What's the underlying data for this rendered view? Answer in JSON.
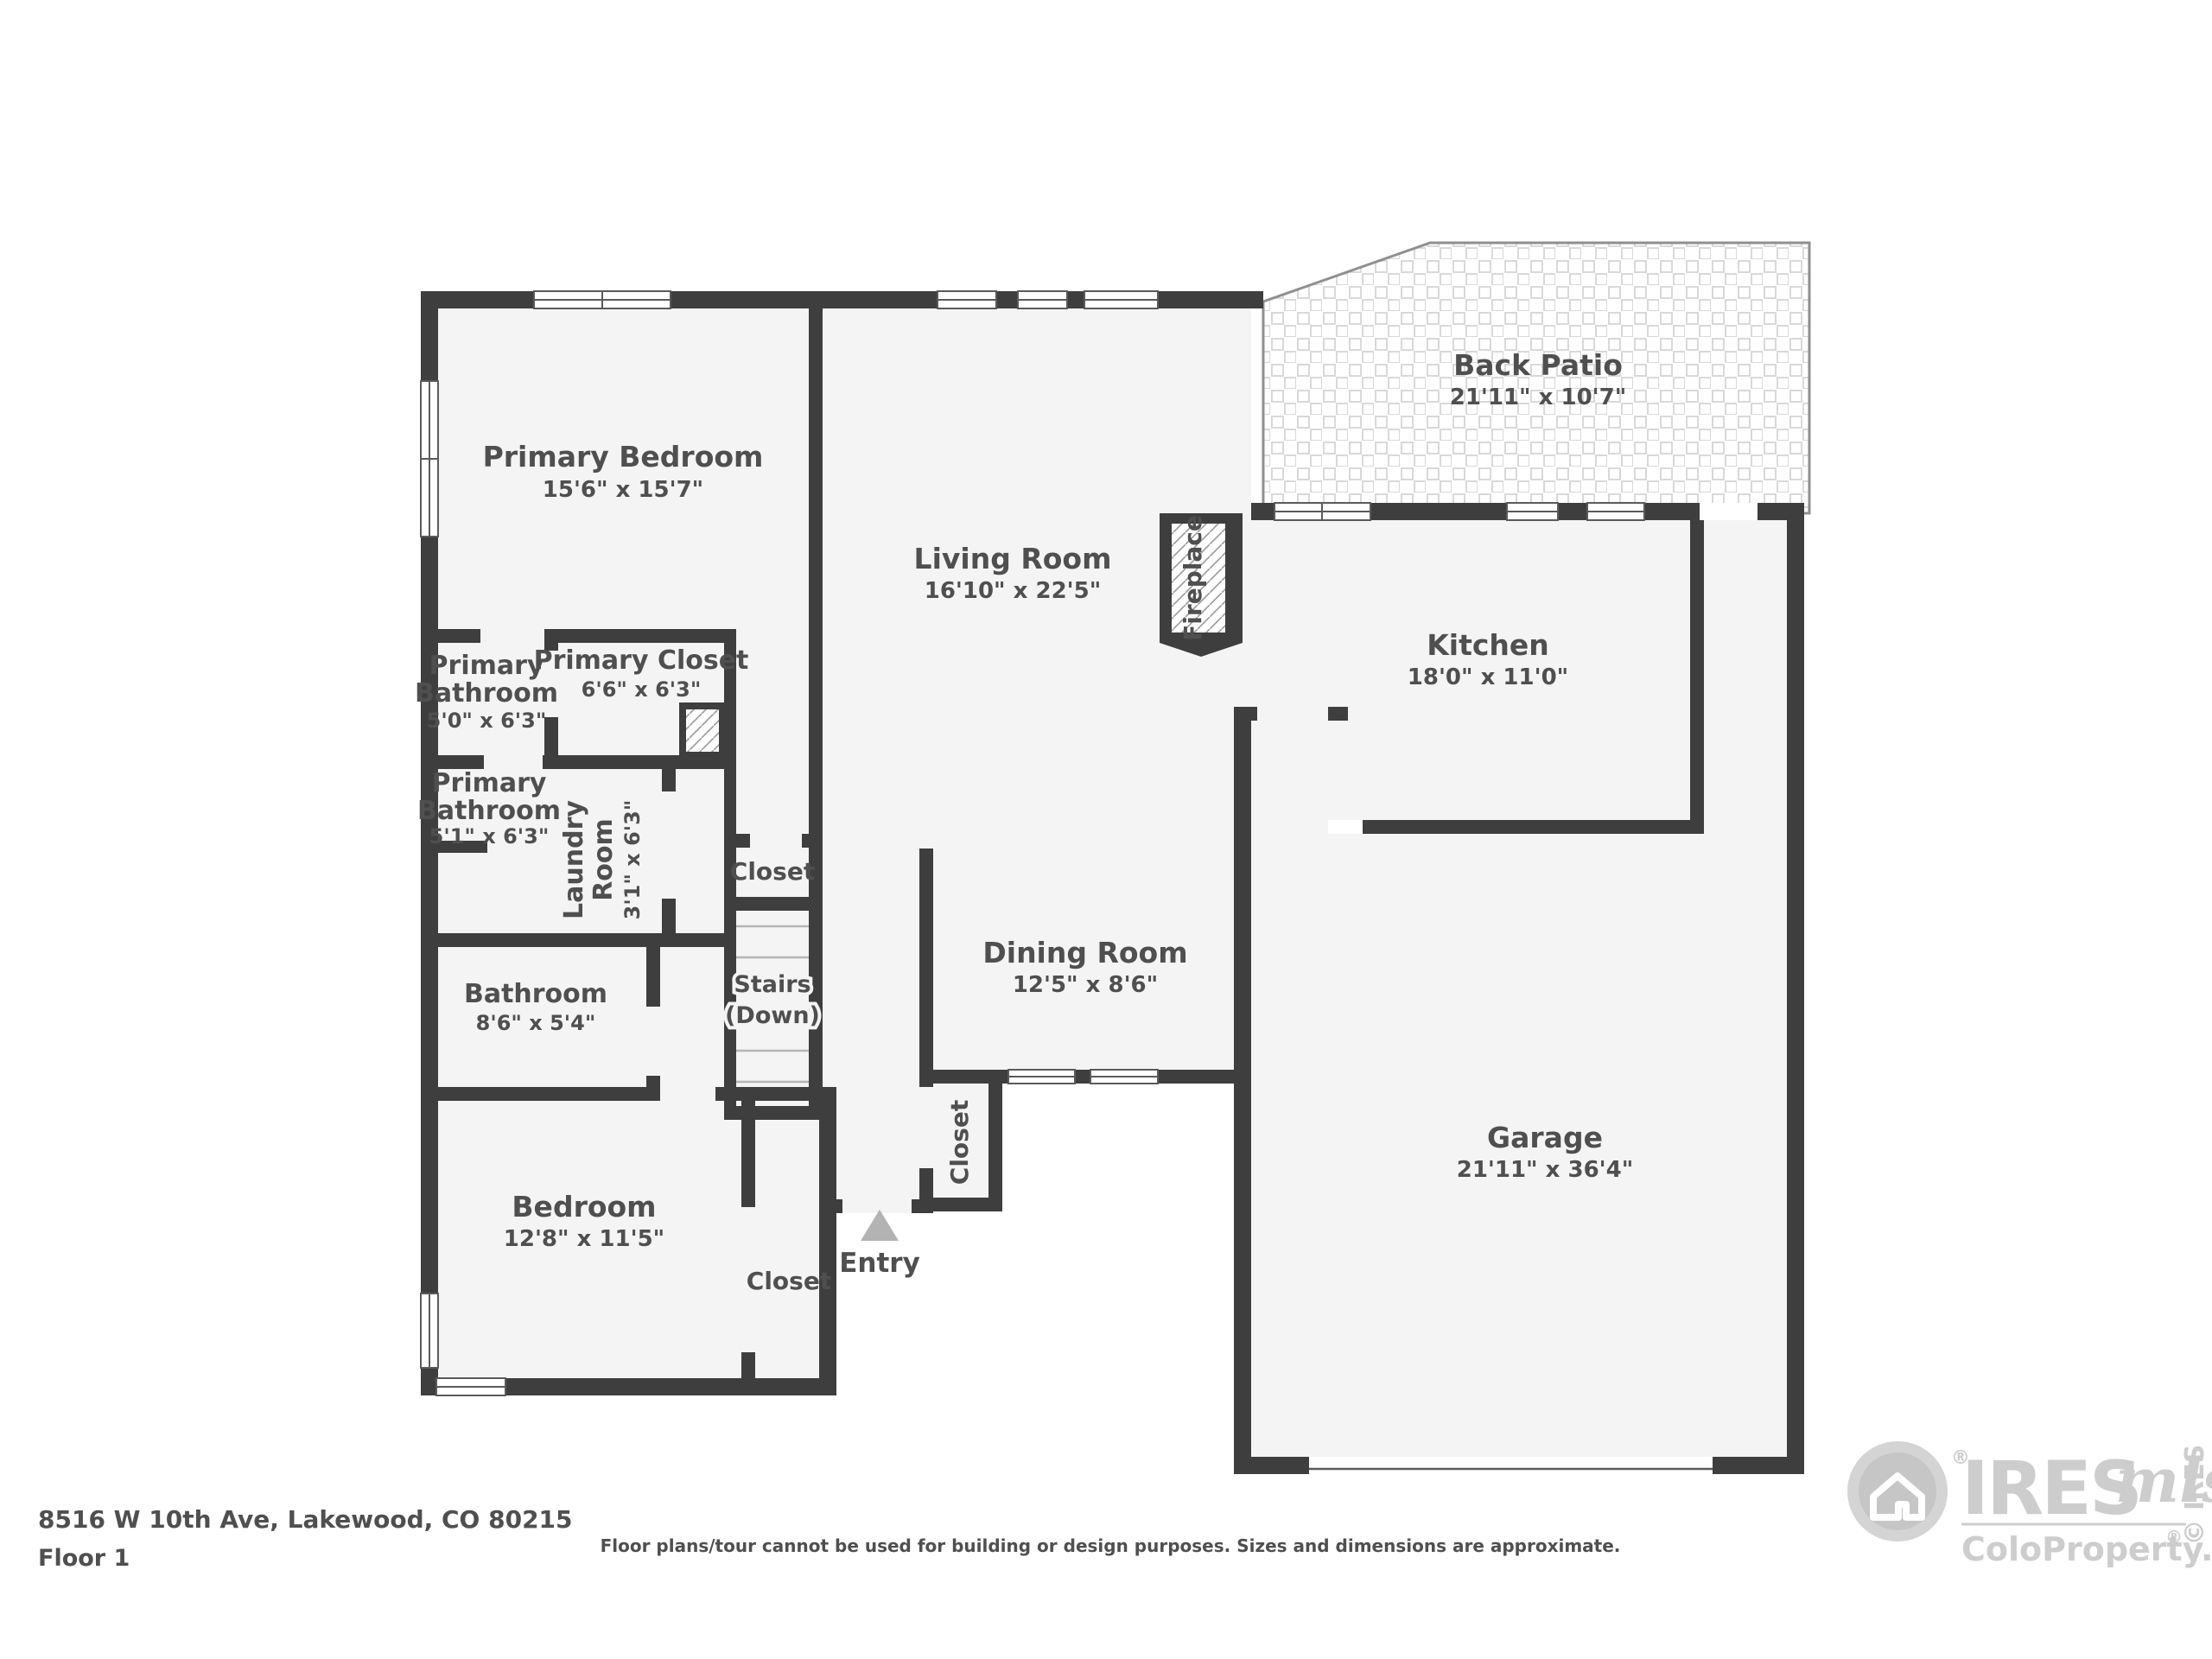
{
  "meta": {
    "address": "8516 W 10th Ave, Lakewood, CO 80215",
    "floor_label": "Floor 1",
    "disclaimer": "Floor plans/tour cannot be used for building or design purposes. Sizes and dimensions are approximate."
  },
  "rooms": {
    "primary_bedroom": {
      "name": "Primary Bedroom",
      "dims": "15'6\" x 15'7\""
    },
    "living_room": {
      "name": "Living Room",
      "dims": "16'10\" x 22'5\""
    },
    "back_patio": {
      "name": "Back Patio",
      "dims": "21'11\" x 10'7\""
    },
    "kitchen": {
      "name": "Kitchen",
      "dims": "18'0\" x 11'0\""
    },
    "dining_room": {
      "name": "Dining Room",
      "dims": "12'5\" x 8'6\""
    },
    "garage": {
      "name": "Garage",
      "dims": "21'11\" x 36'4\""
    },
    "bedroom": {
      "name": "Bedroom",
      "dims": "12'8\" x 11'5\""
    },
    "bathroom": {
      "name": "Bathroom",
      "dims": "8'6\" x 5'4\""
    },
    "primary_bathroom_upper": {
      "line1": "Primary",
      "line2": "Bathroom",
      "dims": "5'0\" x 6'3\""
    },
    "primary_bathroom_lower": {
      "line1": "Primary",
      "line2": "Bathroom",
      "dims": "5'1\" x 6'3\""
    },
    "primary_closet": {
      "name": "Primary Closet",
      "dims": "6'6\" x 6'3\""
    },
    "laundry_room": {
      "line1": "Laundry",
      "line2": "Room",
      "dims": "3'1\" x 6'3\""
    }
  },
  "features": {
    "fireplace": "Fireplace",
    "stairs_line1": "Stairs",
    "stairs_line2": "(Down)",
    "closet_hall": "Closet",
    "closet_bedroom": "Closet",
    "closet_entry": "Closet",
    "entry": "Entry"
  },
  "logo": {
    "registered": "®",
    "brand": "IRES",
    "script": "mls",
    "site": "ColoProperty.com",
    "site_reg": "®",
    "vertical": "© IRES"
  },
  "colors": {
    "wall": "#3e3e3e",
    "floor": "#f4f4f4",
    "text": "#4f4f4f",
    "entry_marker": "#b3b3b3",
    "logo_gray": "#cdcdcd"
  }
}
